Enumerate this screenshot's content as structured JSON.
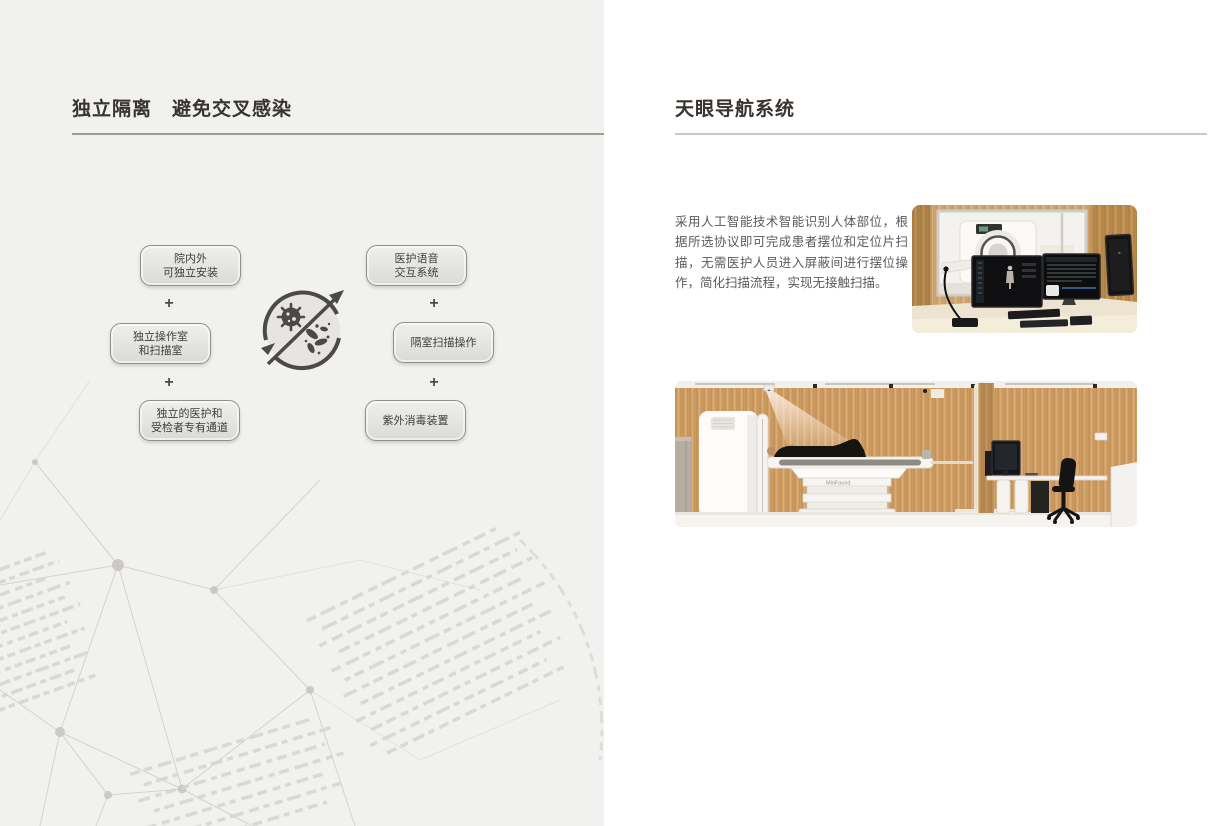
{
  "left_section": {
    "title": "独立隔离　避免交叉感染",
    "diagram": {
      "plus": "+",
      "center_icon": "no-cross-infection",
      "boxes_left": [
        {
          "lines": [
            "院内外",
            "可独立安装"
          ]
        },
        {
          "lines": [
            "独立操作室",
            "和扫描室"
          ]
        },
        {
          "lines": [
            "独立的医护和",
            "受检者专有通道"
          ]
        }
      ],
      "boxes_right": [
        {
          "lines": [
            "医护语音",
            "交互系统"
          ]
        },
        {
          "lines": [
            "隔室扫描操作"
          ]
        },
        {
          "lines": [
            "紫外消毒装置"
          ]
        }
      ]
    }
  },
  "right_section": {
    "title": "天眼导航系统",
    "description": "采用人工智能技术智能识别人体部位，根据所选协议即可完成患者摆位和定位片扫描，无需医护人员进入屏蔽间进行摆位操作，简化扫描流程，实现无接触扫描。",
    "device_label": "MinFound"
  },
  "colors": {
    "left_panel_bg": "#f1f1ef",
    "right_panel_bg": "#ffffff",
    "title_text": "#38332e",
    "rule_left": "#a29a98",
    "rule_right": "#cac7c4",
    "box_border": "#90908e",
    "box_fill_top": "#efefed",
    "box_fill_bottom": "#d9d9d7",
    "icon_dark": "#4d4944",
    "mesh_line": "#cbc8c5",
    "wood": "#c79758",
    "body_text": "#5d5b58"
  }
}
